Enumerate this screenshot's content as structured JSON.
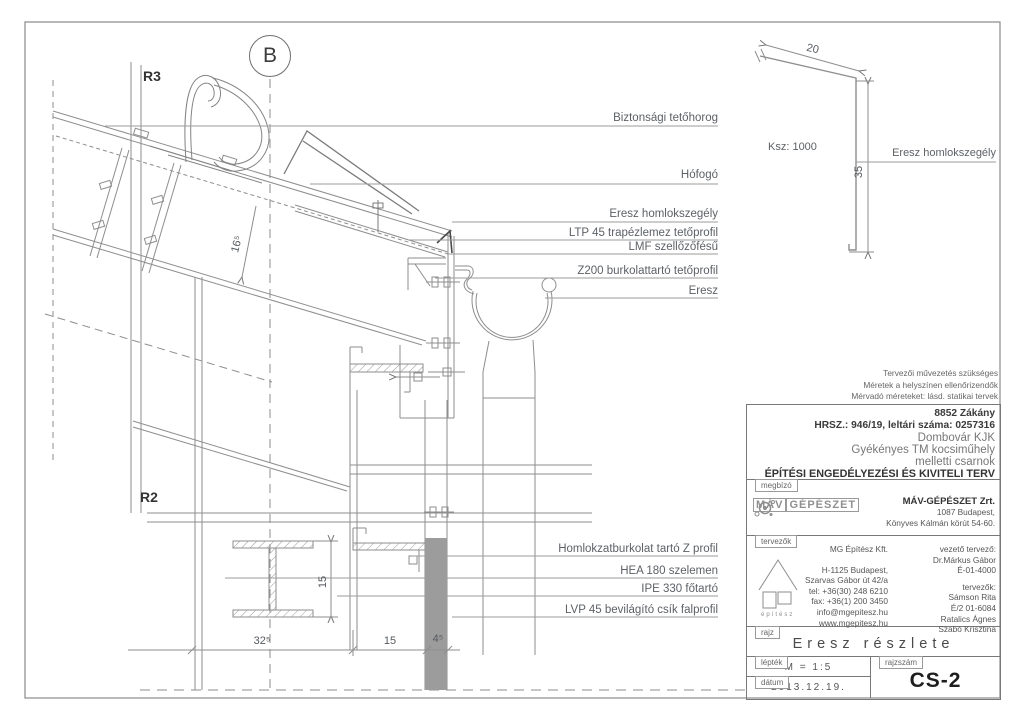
{
  "drawing": {
    "markers": {
      "b": "B",
      "r3": "R3",
      "r2": "R2"
    },
    "callouts_upper": [
      "Biztonsági tetőhorog",
      "Hófogó",
      "Eresz homlokszegély",
      "LTP 45 trapézlemez tetőprofil",
      "LMF szellőzőfésű",
      "Z200 burkolattartó tetőprofil",
      "Eresz"
    ],
    "callouts_lower": [
      "Homlokzatburkolat tartó Z profil",
      "HEA 180 szelemen",
      "IPE 330 főtartó",
      "LVP 45 bevilágító csík falprofil"
    ],
    "dims": {
      "roof_angle": "16⁵",
      "beam_height": "15",
      "w325": "32⁵",
      "w15": "15",
      "w45": "4⁵"
    },
    "colors": {
      "line": "#8e8e8e",
      "fill_column": "#9c9c9c"
    }
  },
  "flashing_detail": {
    "dim_top": "20",
    "dim_side": "35",
    "ksz": "Ksz: 1000",
    "label": "Eresz homlokszegély"
  },
  "title_block": {
    "notes": [
      "Tervezői művezetés szükséges",
      "Méretek a helyszínen ellenőrizendők",
      "Mérvadó méreteket: lásd. statikai tervek"
    ],
    "project": {
      "city": "8852 Zákány",
      "parcel": "HRSZ.: 946/19, leltári száma: 0257316",
      "line1": "Dombovár KJK",
      "line2": "Gyékényes TM kocsiműhely",
      "line3": "melletti csarnok",
      "doc_type": "ÉPÍTÉSI ENGEDÉLYEZÉSI ÉS KIVITELI TERV"
    },
    "client": {
      "tab": "megbízó",
      "logo_left": "MÁV",
      "logo_right": "GÉPÉSZET",
      "name": "MÁV-GÉPÉSZET Zrt.",
      "addr1": "1087 Budapest,",
      "addr2": "Könyves Kálmán körút 54-60."
    },
    "designers": {
      "tab": "tervezők",
      "office": "MG Építész Kft.",
      "office_addr": [
        "H-1125 Budapest,",
        "Szarvas Gábor út 42/a",
        "tel: +36(30) 248 6210",
        "fax: +36(1) 200 3450",
        "info@mgepitesz.hu",
        "www.mgepitesz.hu"
      ],
      "lead_label": "vezető tervező:",
      "lead_name": "Dr.Márkus Gábor",
      "lead_id": "É-01-4000",
      "team_label": "tervezők:",
      "team": [
        "Sámson Rita",
        "É/2 01-6084",
        "Ratalics Ágnes",
        "Szabó Krisztina"
      ],
      "logo_text": "építész"
    },
    "drawing_row": {
      "tab": "rajz",
      "title": "Eresz részlete"
    },
    "scale_row": {
      "tab": "lépték",
      "value": "M = 1:5"
    },
    "date_row": {
      "tab": "dátum",
      "value": "2013.12.19."
    },
    "number_row": {
      "tab": "rajzszám",
      "value": "CS-2"
    }
  }
}
